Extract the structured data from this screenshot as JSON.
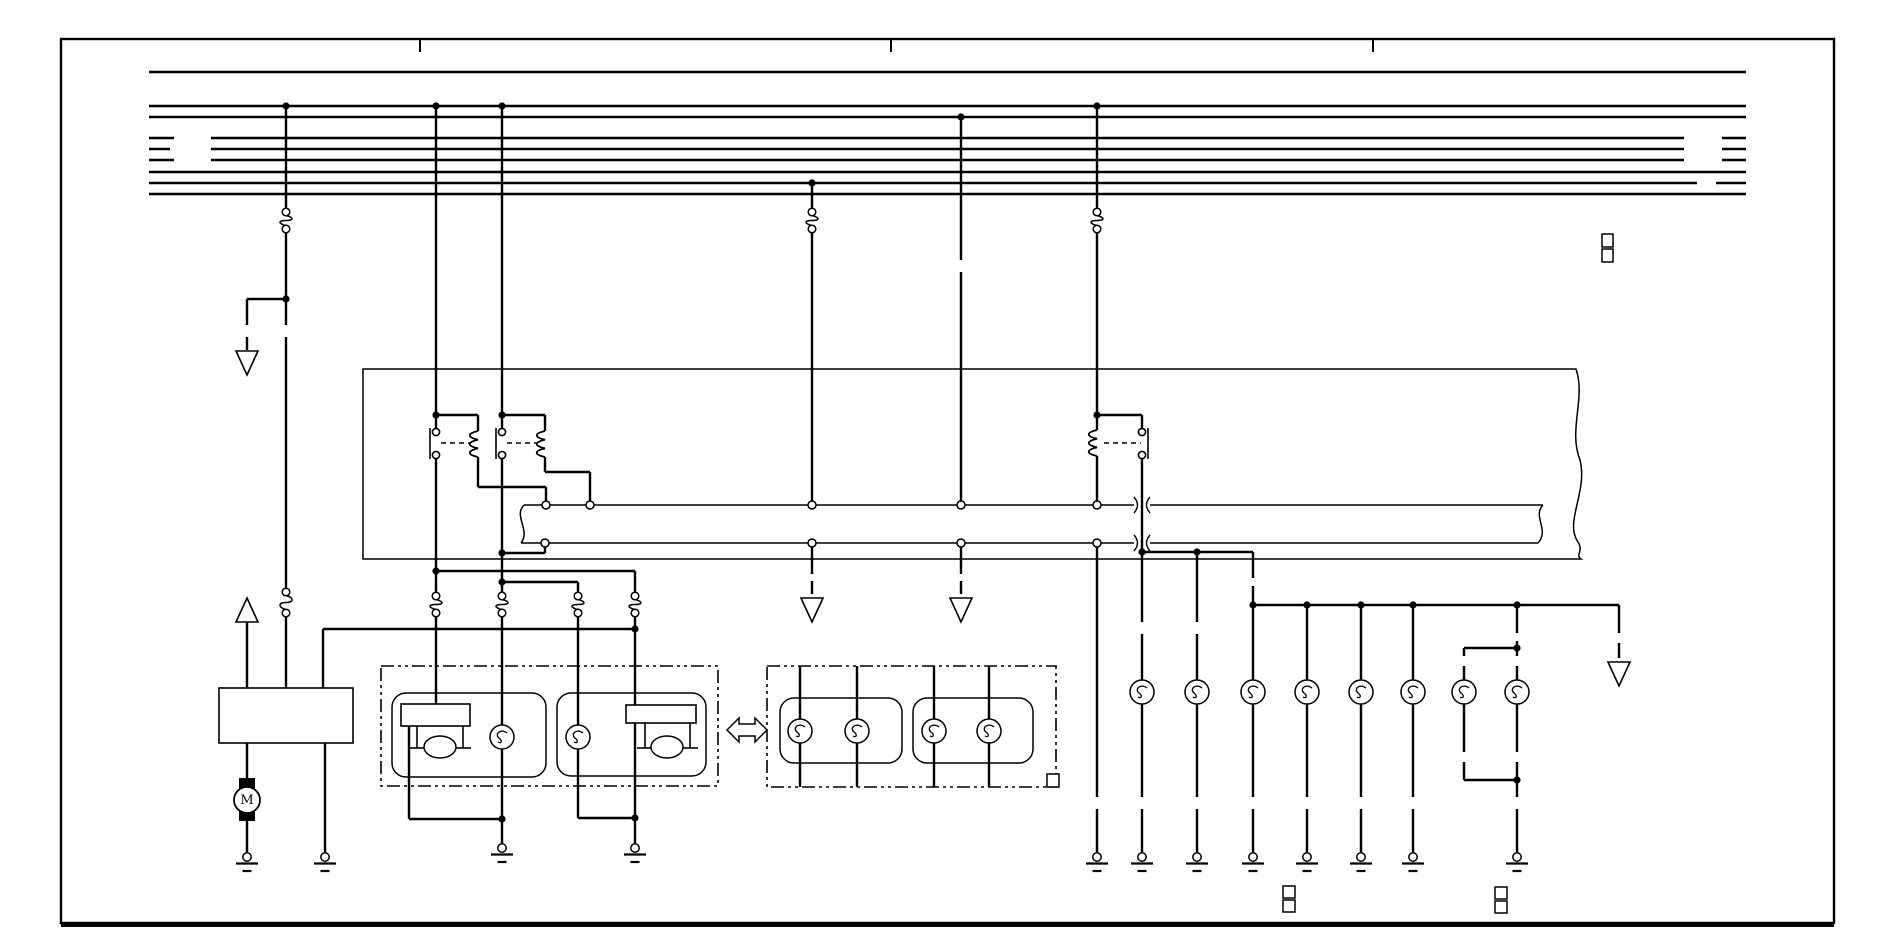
{
  "title": "headlight-circuit-wiring-diagram",
  "ink": "#000000",
  "bg": "#ffffff",
  "motor_label": "M",
  "frame": {
    "x": 61,
    "y": 39,
    "w": 1773,
    "h": 884,
    "bottom_weight": 4,
    "ticks": [
      420,
      891,
      1373
    ],
    "tick_y2": 52
  },
  "bus": {
    "stroke": 2.6,
    "lines": [
      {
        "y": 72,
        "segs": [
          [
            149,
            1746
          ]
        ]
      },
      {
        "y": 106,
        "segs": [
          [
            149,
            1746
          ]
        ]
      },
      {
        "y": 117,
        "segs": [
          [
            149,
            1746
          ]
        ]
      },
      {
        "y": 138,
        "segs": [
          [
            149,
            174
          ],
          [
            211,
            1684
          ],
          [
            1722,
            1746
          ]
        ]
      },
      {
        "y": 149,
        "segs": [
          [
            149,
            170
          ],
          [
            211,
            1684
          ],
          [
            1722,
            1746
          ]
        ]
      },
      {
        "y": 160,
        "segs": [
          [
            149,
            174
          ],
          [
            211,
            1684
          ],
          [
            1722,
            1746
          ]
        ]
      },
      {
        "y": 172,
        "segs": [
          [
            149,
            1746
          ]
        ]
      },
      {
        "y": 183,
        "segs": [
          [
            149,
            1697
          ],
          [
            1716,
            1746
          ]
        ]
      },
      {
        "y": 194,
        "segs": [
          [
            149,
            1746
          ]
        ]
      }
    ]
  },
  "wires": [
    [
      286,
      106,
      286,
      208
    ],
    [
      286,
      233,
      286,
      299
    ],
    [
      286,
      299,
      286,
      325
    ],
    [
      286,
      337,
      286,
      588
    ],
    [
      286,
      617,
      286,
      688
    ],
    [
      286,
      299,
      247,
      299
    ],
    [
      247,
      299,
      247,
      325
    ],
    [
      247,
      337,
      247,
      350
    ],
    [
      247,
      622,
      247,
      688
    ],
    [
      247,
      743,
      247,
      778
    ],
    [
      247,
      821,
      247,
      852
    ],
    [
      325,
      743,
      325,
      852
    ],
    [
      436,
      106,
      436,
      428
    ],
    [
      436,
      459,
      436,
      592
    ],
    [
      436,
      617,
      436,
      704
    ],
    [
      436,
      571,
      635,
      571
    ],
    [
      436,
      415,
      478,
      415
    ],
    [
      478,
      415,
      478,
      431
    ],
    [
      478,
      457,
      478,
      487
    ],
    [
      478,
      487,
      546,
      487
    ],
    [
      546,
      487,
      546,
      501
    ],
    [
      502,
      106,
      502,
      428
    ],
    [
      502,
      459,
      502,
      592
    ],
    [
      502,
      617,
      502,
      725
    ],
    [
      502,
      749,
      502,
      843
    ],
    [
      502,
      415,
      545,
      415
    ],
    [
      545,
      415,
      545,
      431
    ],
    [
      545,
      457,
      545,
      472
    ],
    [
      545,
      472,
      590,
      472
    ],
    [
      590,
      472,
      590,
      501
    ],
    [
      545,
      547,
      545,
      553
    ],
    [
      545,
      553,
      502,
      553
    ],
    [
      502,
      582,
      578,
      582
    ],
    [
      578,
      582,
      578,
      592
    ],
    [
      578,
      617,
      578,
      725
    ],
    [
      578,
      749,
      578,
      818
    ],
    [
      578,
      818,
      635,
      818
    ],
    [
      635,
      571,
      635,
      592
    ],
    [
      635,
      617,
      635,
      705
    ],
    [
      635,
      723,
      635,
      843
    ],
    [
      409,
      726,
      409,
      819
    ],
    [
      409,
      819,
      502,
      819
    ],
    [
      323,
      629,
      635,
      629
    ],
    [
      323,
      629,
      323,
      688
    ],
    [
      812,
      183,
      812,
      208
    ],
    [
      812,
      233,
      812,
      501
    ],
    [
      812,
      547,
      812,
      574
    ],
    [
      812,
      581,
      812,
      594
    ],
    [
      961,
      117,
      961,
      260
    ],
    [
      961,
      272,
      961,
      501
    ],
    [
      961,
      547,
      961,
      574
    ],
    [
      961,
      581,
      961,
      594
    ],
    [
      1097,
      106,
      1097,
      208
    ],
    [
      1097,
      233,
      1097,
      430
    ],
    [
      1097,
      456,
      1097,
      501
    ],
    [
      1097,
      415,
      1142,
      415
    ],
    [
      1142,
      415,
      1142,
      428
    ],
    [
      1142,
      459,
      1142,
      552
    ],
    [
      1097,
      547,
      1097,
      797
    ],
    [
      1097,
      809,
      1097,
      852
    ],
    [
      1142,
      552,
      1253,
      552
    ],
    [
      1142,
      552,
      1142,
      622
    ],
    [
      1142,
      634,
      1142,
      680
    ],
    [
      1142,
      704,
      1142,
      797
    ],
    [
      1142,
      809,
      1142,
      852
    ],
    [
      1197,
      552,
      1197,
      622
    ],
    [
      1197,
      634,
      1197,
      680
    ],
    [
      1197,
      704,
      1197,
      797
    ],
    [
      1197,
      809,
      1197,
      852
    ],
    [
      1253,
      552,
      1253,
      578
    ],
    [
      1253,
      586,
      1253,
      605
    ],
    [
      1253,
      605,
      1619,
      605
    ],
    [
      1253,
      605,
      1253,
      680
    ],
    [
      1253,
      704,
      1253,
      797
    ],
    [
      1253,
      809,
      1253,
      852
    ],
    [
      1307,
      605,
      1307,
      680
    ],
    [
      1307,
      704,
      1307,
      797
    ],
    [
      1307,
      809,
      1307,
      852
    ],
    [
      1361,
      605,
      1361,
      680
    ],
    [
      1361,
      704,
      1361,
      797
    ],
    [
      1361,
      809,
      1361,
      852
    ],
    [
      1413,
      605,
      1413,
      680
    ],
    [
      1413,
      704,
      1413,
      797
    ],
    [
      1413,
      809,
      1413,
      852
    ],
    [
      1517,
      605,
      1517,
      633
    ],
    [
      1517,
      641,
      1517,
      656
    ],
    [
      1517,
      666,
      1517,
      680
    ],
    [
      1517,
      704,
      1517,
      752
    ],
    [
      1517,
      762,
      1517,
      797
    ],
    [
      1517,
      809,
      1517,
      852
    ],
    [
      1464,
      648,
      1517,
      648
    ],
    [
      1464,
      648,
      1464,
      656
    ],
    [
      1464,
      666,
      1464,
      680
    ],
    [
      1464,
      704,
      1464,
      752
    ],
    [
      1464,
      762,
      1464,
      780
    ],
    [
      1464,
      780,
      1517,
      780
    ],
    [
      1619,
      605,
      1619,
      633
    ],
    [
      1619,
      643,
      1619,
      658
    ],
    [
      800,
      666,
      800,
      719
    ],
    [
      800,
      743,
      800,
      787
    ],
    [
      857,
      666,
      857,
      719
    ],
    [
      857,
      743,
      857,
      787
    ],
    [
      934,
      666,
      934,
      719
    ],
    [
      934,
      743,
      934,
      787
    ],
    [
      989,
      666,
      989,
      719
    ],
    [
      989,
      743,
      989,
      787
    ]
  ],
  "thin_lines": [
    [
      430,
      428,
      430,
      459
    ],
    [
      496,
      428,
      496,
      459
    ],
    [
      1148,
      428,
      1148,
      459
    ],
    [
      417,
      726,
      417,
      748
    ],
    [
      463,
      726,
      463,
      748
    ],
    [
      409,
      748,
      425,
      748
    ],
    [
      455,
      748,
      471,
      748
    ],
    [
      645,
      723,
      645,
      748
    ],
    [
      690,
      723,
      690,
      748
    ],
    [
      637,
      748,
      653,
      748
    ],
    [
      682,
      748,
      698,
      748
    ]
  ],
  "dash_links": [
    [
      441,
      443,
      470,
      443
    ],
    [
      507,
      443,
      537,
      443
    ],
    [
      1104,
      443,
      1141,
      443
    ]
  ],
  "coils": [
    [
      478,
      431
    ],
    [
      545,
      431
    ],
    [
      1097,
      430
    ]
  ],
  "contact_circles": [
    [
      436,
      432
    ],
    [
      436,
      455
    ],
    [
      502,
      432
    ],
    [
      502,
      455
    ],
    [
      1142,
      432
    ],
    [
      1142,
      455
    ]
  ],
  "dots": [
    [
      286,
      106
    ],
    [
      436,
      106
    ],
    [
      502,
      106
    ],
    [
      1097,
      106
    ],
    [
      961,
      117
    ],
    [
      812,
      183
    ],
    [
      286,
      299
    ],
    [
      436,
      415
    ],
    [
      502,
      415
    ],
    [
      1097,
      415
    ],
    [
      502,
      553
    ],
    [
      436,
      571
    ],
    [
      502,
      582
    ],
    [
      635,
      629
    ],
    [
      502,
      819
    ],
    [
      635,
      818
    ],
    [
      1142,
      552
    ],
    [
      1197,
      552
    ],
    [
      1253,
      605
    ],
    [
      1307,
      605
    ],
    [
      1361,
      605
    ],
    [
      1413,
      605
    ],
    [
      1517,
      605
    ],
    [
      1517,
      648
    ],
    [
      1517,
      780
    ]
  ],
  "pins": [
    [
      546,
      505
    ],
    [
      590,
      505
    ],
    [
      812,
      505
    ],
    [
      961,
      505
    ],
    [
      1097,
      505
    ],
    [
      545,
      543
    ],
    [
      812,
      543
    ],
    [
      961,
      543
    ],
    [
      1097,
      543
    ]
  ],
  "fuses": [
    [
      286,
      208,
      233
    ],
    [
      812,
      208,
      233
    ],
    [
      1097,
      208,
      233
    ],
    [
      286,
      588,
      617
    ],
    [
      436,
      592,
      617
    ],
    [
      502,
      592,
      617
    ],
    [
      578,
      592,
      617
    ],
    [
      635,
      592,
      617
    ]
  ],
  "grounds": [
    [
      247,
      852
    ],
    [
      325,
      852
    ],
    [
      502,
      843
    ],
    [
      635,
      843
    ],
    [
      1097,
      852
    ],
    [
      1142,
      852
    ],
    [
      1197,
      852
    ],
    [
      1253,
      852
    ],
    [
      1307,
      852
    ],
    [
      1361,
      852
    ],
    [
      1413,
      852
    ],
    [
      1517,
      852
    ]
  ],
  "arrows_down": [
    [
      247,
      351
    ],
    [
      812,
      598
    ],
    [
      961,
      598
    ],
    [
      1619,
      662
    ]
  ],
  "arrows_up": [
    [
      247,
      598
    ]
  ],
  "bulbs": [
    [
      502,
      737
    ],
    [
      578,
      737
    ],
    [
      800,
      731
    ],
    [
      857,
      731
    ],
    [
      934,
      731
    ],
    [
      989,
      731
    ],
    [
      1142,
      692
    ],
    [
      1197,
      692
    ],
    [
      1253,
      692
    ],
    [
      1307,
      692
    ],
    [
      1361,
      692
    ],
    [
      1413,
      692
    ],
    [
      1464,
      692
    ],
    [
      1517,
      692
    ]
  ],
  "domes": [
    [
      440,
      747
    ],
    [
      667,
      747
    ]
  ],
  "solid_rects": [
    [
      219,
      688,
      134,
      55
    ],
    [
      401,
      704,
      69,
      22
    ],
    [
      626,
      705,
      70,
      18
    ]
  ],
  "rounded_rects": [
    [
      392,
      693,
      154,
      84
    ],
    [
      557,
      693,
      149,
      83
    ],
    [
      780,
      698,
      122,
      65
    ],
    [
      913,
      698,
      120,
      65
    ]
  ],
  "dashdot_rects": [
    [
      381,
      666,
      337,
      120
    ],
    [
      767,
      666,
      289,
      121
    ]
  ],
  "big_box_path": "M363,369 H1576 C1586,398 1568,430 1580,460 C1588,492 1564,522 1578,542 C1584,551 1575,555 1581,559 H363 Z",
  "strip": {
    "lines": [
      [
        524,
        505,
        1134,
        505
      ],
      [
        1150,
        505,
        1543,
        505
      ],
      [
        521,
        543,
        1134,
        543
      ],
      [
        1150,
        543,
        1538,
        543
      ]
    ],
    "torn": [
      "M524,505 C513,516 531,530 521,543",
      "M1543,505 C1532,516 1550,530 1538,543"
    ],
    "cross_arcs": [
      "M1134,497 Q1141,505 1134,513",
      "M1150,497 Q1143,505 1150,513",
      "M1134,535 Q1141,543 1134,551",
      "M1150,535 Q1143,543 1150,551"
    ]
  },
  "squares": [
    [
      1602,
      234,
      11,
      13
    ],
    [
      1602,
      249,
      11,
      13
    ],
    [
      1283,
      886,
      12,
      12
    ],
    [
      1283,
      900,
      12,
      12
    ],
    [
      1495,
      887,
      12,
      12
    ],
    [
      1495,
      901,
      12,
      12
    ],
    [
      1047,
      774,
      12,
      13
    ]
  ],
  "motor": {
    "x": 247,
    "y": 800,
    "r": 13,
    "caps": [
      [
        239,
        778,
        16,
        11
      ],
      [
        239,
        810,
        16,
        11
      ]
    ]
  },
  "swap_arrow": "727,730 739,718 739,724 755,724 755,718 767,730 755,742 755,736 739,736 739,742"
}
